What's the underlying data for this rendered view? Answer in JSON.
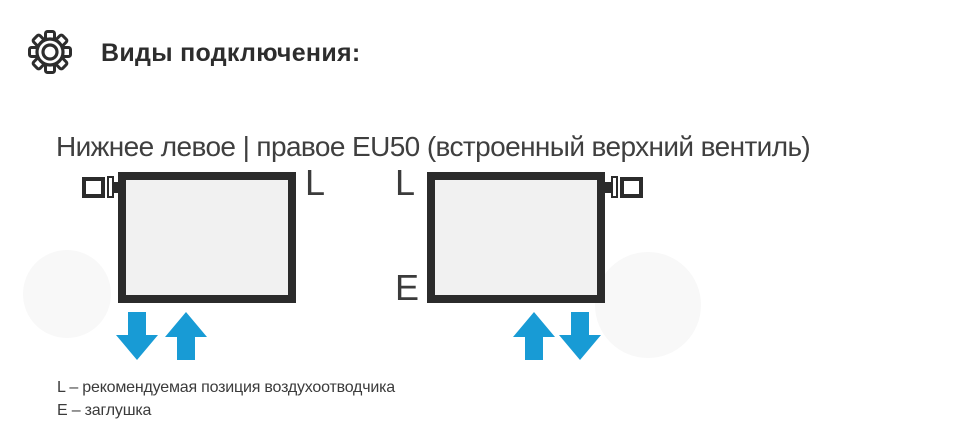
{
  "header": {
    "icon": "gear-icon",
    "title": "Виды подключения:"
  },
  "subtitle": "Нижнее левое | правое EU50 (встроенный верхний вентиль)",
  "diagram": {
    "left_radiator": {
      "valve_fitting_side": "top-left",
      "label_top_right": "L",
      "arrows": [
        "down",
        "up"
      ]
    },
    "right_radiator": {
      "valve_fitting_side": "top-right",
      "label_top_left": "L",
      "label_bottom_left": "E",
      "arrows": [
        "up",
        "down"
      ]
    }
  },
  "legend": {
    "lines": [
      "L – рекомендуемая позиция воздухоотводчика",
      "E – заглушка"
    ]
  },
  "colors": {
    "arrow_blue": "#189bd5",
    "radiator_border": "#2b2b2b",
    "radiator_fill": "#f1f1f1",
    "title_text": "#2d2d2d",
    "body_text": "#3f3f3f",
    "background": "#ffffff"
  }
}
